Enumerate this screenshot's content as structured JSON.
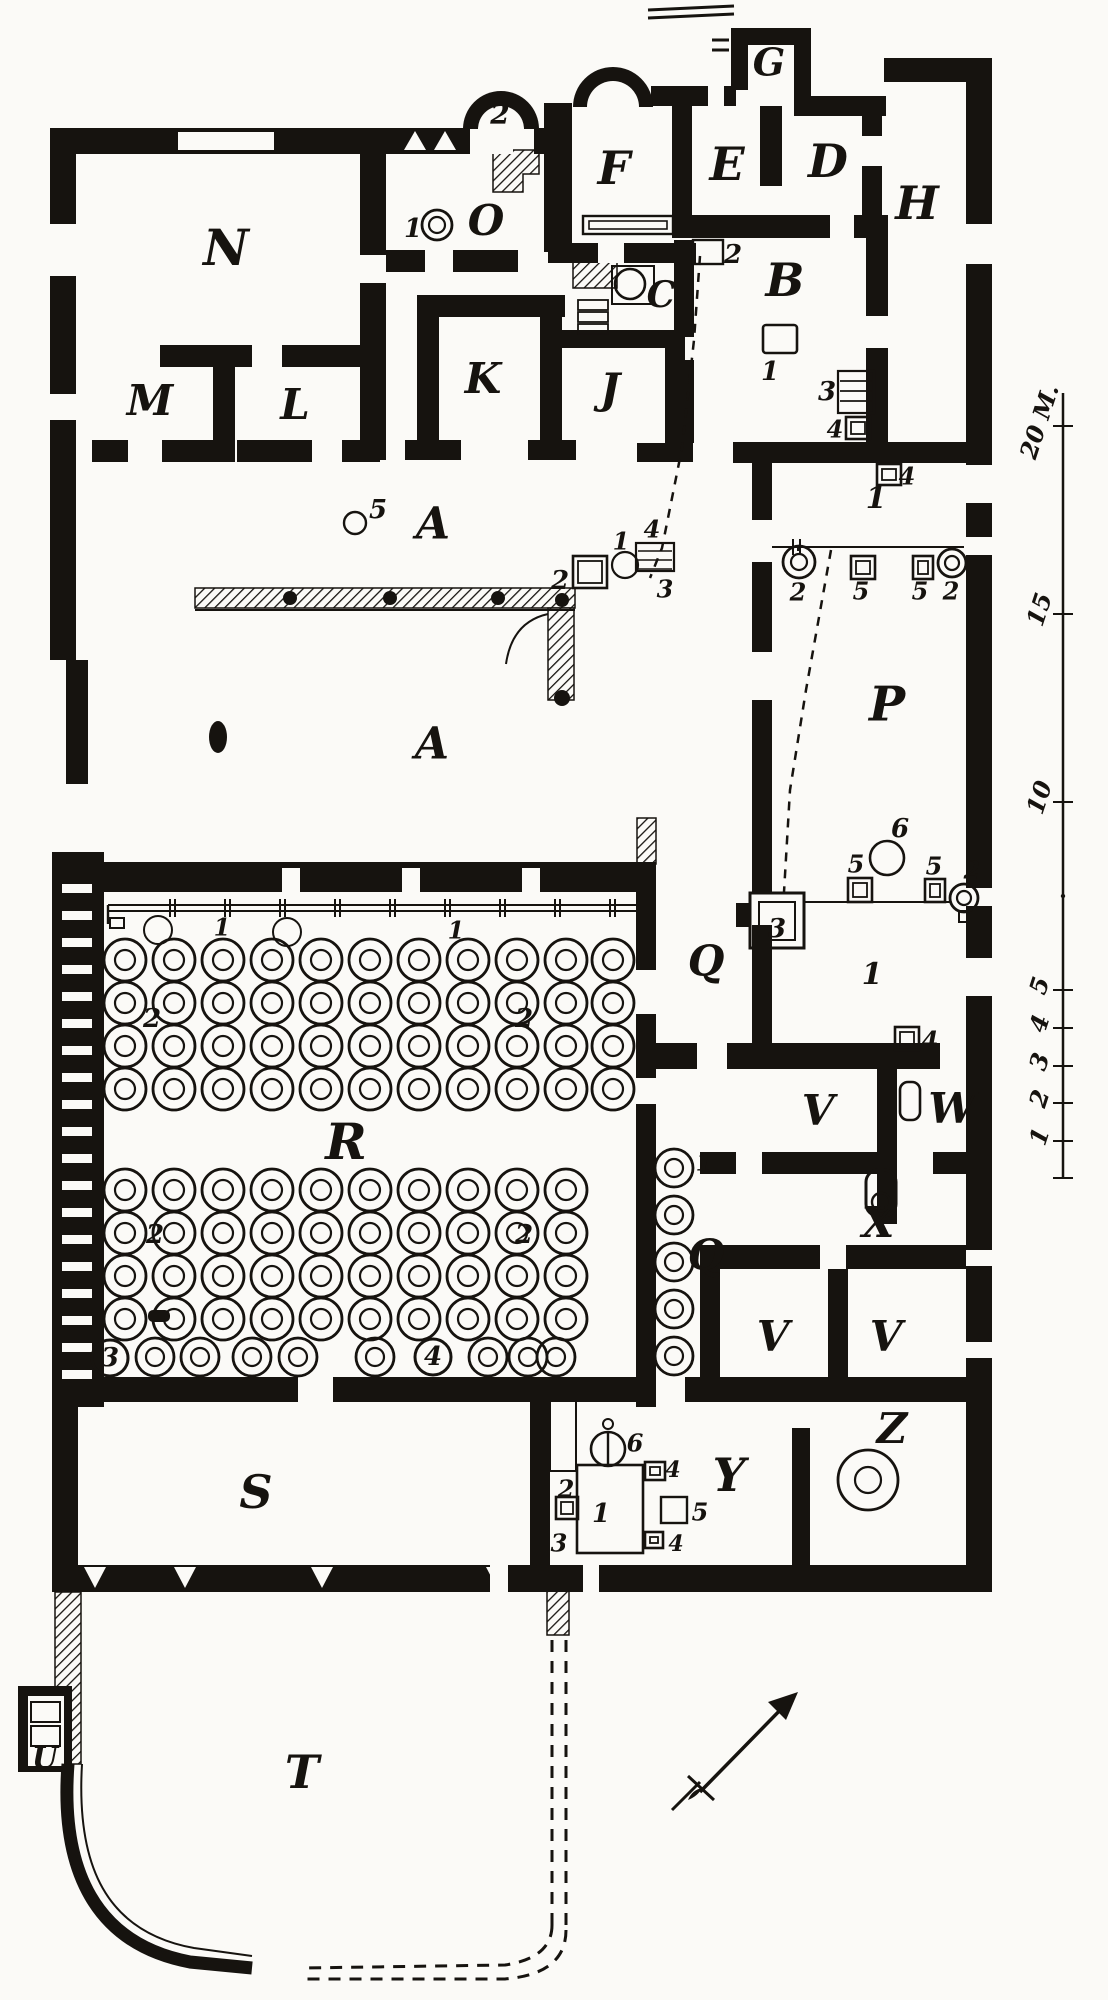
{
  "figure": {
    "type": "floor-plan",
    "description": "Excavation ground plan of a villa with lettered rooms, dolia jar grids, press installations, meter scale bar and north arrow",
    "background": "#fbfaf7",
    "ink": "#16130f"
  },
  "room_labels": [
    {
      "id": "N",
      "label": "N",
      "x": 226,
      "y": 252,
      "fs": 50
    },
    {
      "id": "M",
      "label": "M",
      "x": 150,
      "y": 404,
      "fs": 42
    },
    {
      "id": "L",
      "label": "L",
      "x": 295,
      "y": 408,
      "fs": 42
    },
    {
      "id": "K",
      "label": "K",
      "x": 483,
      "y": 382,
      "fs": 42
    },
    {
      "id": "J",
      "label": "J",
      "x": 610,
      "y": 392,
      "fs": 42
    },
    {
      "id": "O",
      "label": "O",
      "x": 486,
      "y": 224,
      "fs": 42
    },
    {
      "id": "F",
      "label": "F",
      "x": 614,
      "y": 172,
      "fs": 46
    },
    {
      "id": "E",
      "label": "E",
      "x": 727,
      "y": 168,
      "fs": 46
    },
    {
      "id": "G",
      "label": "G",
      "x": 769,
      "y": 66,
      "fs": 38
    },
    {
      "id": "D",
      "label": "D",
      "x": 828,
      "y": 165,
      "fs": 46
    },
    {
      "id": "H",
      "label": "H",
      "x": 917,
      "y": 207,
      "fs": 46
    },
    {
      "id": "B",
      "label": "B",
      "x": 785,
      "y": 284,
      "fs": 46
    },
    {
      "id": "C",
      "label": "C",
      "x": 661,
      "y": 298,
      "fs": 36
    },
    {
      "id": "A1",
      "label": "A",
      "x": 433,
      "y": 527,
      "fs": 44
    },
    {
      "id": "A2",
      "label": "A",
      "x": 432,
      "y": 747,
      "fs": 44
    },
    {
      "id": "P",
      "label": "P",
      "x": 887,
      "y": 708,
      "fs": 48
    },
    {
      "id": "Q1",
      "label": "Q",
      "x": 706,
      "y": 964,
      "fs": 42
    },
    {
      "id": "Q2",
      "label": "Q",
      "x": 706,
      "y": 1258,
      "fs": 42
    },
    {
      "id": "R",
      "label": "R",
      "x": 346,
      "y": 1146,
      "fs": 50
    },
    {
      "id": "S",
      "label": "S",
      "x": 256,
      "y": 1496,
      "fs": 46
    },
    {
      "id": "V1",
      "label": "V",
      "x": 818,
      "y": 1114,
      "fs": 42
    },
    {
      "id": "W",
      "label": "W",
      "x": 952,
      "y": 1112,
      "fs": 42
    },
    {
      "id": "X",
      "label": "X",
      "x": 878,
      "y": 1226,
      "fs": 42
    },
    {
      "id": "V2",
      "label": "V",
      "x": 773,
      "y": 1340,
      "fs": 42
    },
    {
      "id": "V3",
      "label": "V",
      "x": 886,
      "y": 1340,
      "fs": 42
    },
    {
      "id": "Y",
      "label": "Y",
      "x": 729,
      "y": 1479,
      "fs": 46
    },
    {
      "id": "Z",
      "label": "Z",
      "x": 892,
      "y": 1432,
      "fs": 42
    },
    {
      "id": "U",
      "label": "U",
      "x": 45,
      "y": 1760,
      "fs": 30
    },
    {
      "id": "T",
      "label": "T",
      "x": 302,
      "y": 1776,
      "fs": 46
    }
  ],
  "feature_numbers": [
    {
      "label": "1",
      "x": 413,
      "y": 230,
      "fs": 26
    },
    {
      "label": "2",
      "x": 500,
      "y": 116,
      "fs": 28
    },
    {
      "label": "2",
      "x": 733,
      "y": 256,
      "fs": 26
    },
    {
      "label": "1",
      "x": 770,
      "y": 373,
      "fs": 26
    },
    {
      "label": "3",
      "x": 827,
      "y": 393,
      "fs": 26
    },
    {
      "label": "4",
      "x": 835,
      "y": 431,
      "fs": 24
    },
    {
      "label": "4",
      "x": 907,
      "y": 478,
      "fs": 24
    },
    {
      "label": "1",
      "x": 876,
      "y": 500,
      "fs": 30
    },
    {
      "label": "2",
      "x": 798,
      "y": 594,
      "fs": 24
    },
    {
      "label": "5",
      "x": 861,
      "y": 593,
      "fs": 24
    },
    {
      "label": "5",
      "x": 920,
      "y": 593,
      "fs": 24
    },
    {
      "label": "2",
      "x": 951,
      "y": 593,
      "fs": 24
    },
    {
      "label": "6",
      "x": 900,
      "y": 830,
      "fs": 26
    },
    {
      "label": "5",
      "x": 856,
      "y": 866,
      "fs": 24
    },
    {
      "label": "5",
      "x": 934,
      "y": 868,
      "fs": 24
    },
    {
      "label": "2",
      "x": 972,
      "y": 872,
      "fs": 24
    },
    {
      "label": "3",
      "x": 777,
      "y": 930,
      "fs": 26
    },
    {
      "label": "1",
      "x": 872,
      "y": 976,
      "fs": 30
    },
    {
      "label": "4",
      "x": 930,
      "y": 1042,
      "fs": 24
    },
    {
      "label": "5",
      "x": 378,
      "y": 511,
      "fs": 26
    },
    {
      "label": "2",
      "x": 560,
      "y": 582,
      "fs": 26
    },
    {
      "label": "1",
      "x": 621,
      "y": 543,
      "fs": 24
    },
    {
      "label": "4",
      "x": 652,
      "y": 531,
      "fs": 24
    },
    {
      "label": "3",
      "x": 665,
      "y": 591,
      "fs": 24
    },
    {
      "label": "1",
      "x": 222,
      "y": 929,
      "fs": 24
    },
    {
      "label": "1",
      "x": 456,
      "y": 932,
      "fs": 24
    },
    {
      "label": "2",
      "x": 152,
      "y": 1020,
      "fs": 26
    },
    {
      "label": "2",
      "x": 524,
      "y": 1020,
      "fs": 26
    },
    {
      "label": "2",
      "x": 155,
      "y": 1236,
      "fs": 26
    },
    {
      "label": "2",
      "x": 524,
      "y": 1236,
      "fs": 26
    },
    {
      "label": "1",
      "x": 704,
      "y": 1164,
      "fs": 24
    },
    {
      "label": "2",
      "x": 566,
      "y": 1491,
      "fs": 24
    },
    {
      "label": "3",
      "x": 559,
      "y": 1545,
      "fs": 24
    },
    {
      "label": "1",
      "x": 601,
      "y": 1515,
      "fs": 26
    },
    {
      "label": "6",
      "x": 635,
      "y": 1445,
      "fs": 24
    },
    {
      "label": "4",
      "x": 673,
      "y": 1471,
      "fs": 22
    },
    {
      "label": "5",
      "x": 700,
      "y": 1514,
      "fs": 24
    },
    {
      "label": "4",
      "x": 676,
      "y": 1545,
      "fs": 22
    }
  ],
  "circled_numbers": [
    {
      "label": "3",
      "x": 110,
      "y": 1358
    },
    {
      "label": "4",
      "x": 433,
      "y": 1357
    }
  ],
  "scale_bar": {
    "x": 1063,
    "top": 393,
    "bottom": 1178,
    "ticks": [
      {
        "label": "20 M.",
        "y": 426
      },
      {
        "label": "15",
        "y": 614
      },
      {
        "label": "10",
        "y": 802
      },
      {
        "label": "5",
        "y": 990
      },
      {
        "label": "4",
        "y": 1028
      },
      {
        "label": "3",
        "y": 1066
      },
      {
        "label": "2",
        "y": 1103
      },
      {
        "label": "1",
        "y": 1141
      }
    ]
  },
  "dolia": {
    "upper_grid": {
      "cols": [
        125,
        174,
        223,
        272,
        321,
        370,
        419,
        468,
        517,
        566,
        613
      ],
      "rows": [
        960,
        1003,
        1046,
        1089
      ],
      "r_outer": 21,
      "r_inner": 10
    },
    "lower_grid": {
      "cols": [
        125,
        174,
        223,
        272,
        321,
        370,
        419,
        468,
        517,
        566
      ],
      "rows": [
        1190,
        1233,
        1276,
        1319
      ],
      "r_outer": 21,
      "r_inner": 10
    },
    "bottom_row": {
      "xs": [
        155,
        200,
        252,
        298,
        375,
        488,
        528,
        556
      ],
      "y": 1357,
      "r_outer": 19,
      "r_inner": 9
    },
    "corridor_col": {
      "x": 674,
      "ys": [
        1168,
        1215,
        1262,
        1309,
        1356
      ],
      "r_outer": 19,
      "r_inner": 9
    },
    "thin_circles": [
      [
        158,
        930
      ],
      [
        287,
        932
      ]
    ],
    "small_circle_A": [
      355,
      523
    ]
  },
  "compass": {
    "name": "north-arrow",
    "direction": "NE"
  }
}
